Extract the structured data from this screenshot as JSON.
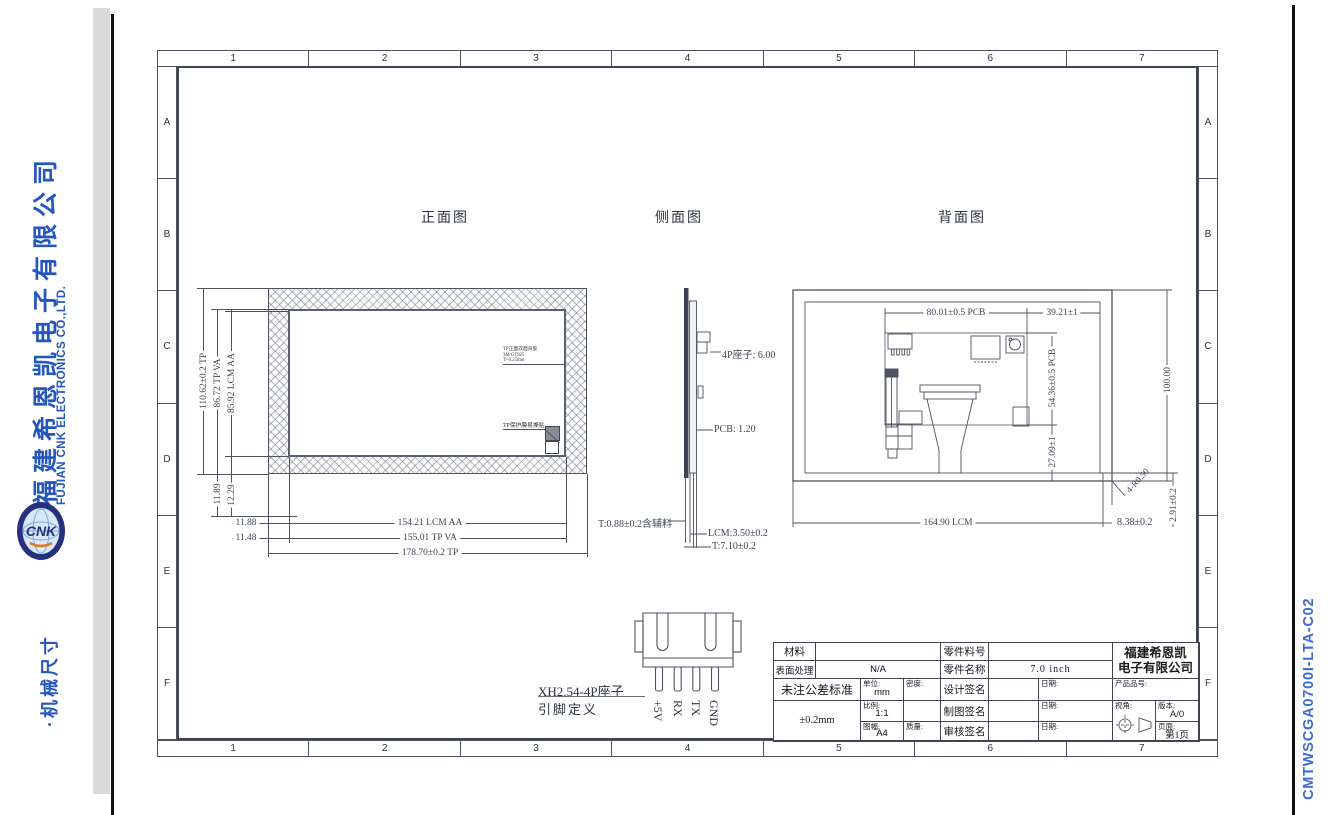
{
  "sidebar": {
    "company_cn": "福建希恩凯电子有限公司",
    "company_en": "FUJIAN CNK ELECTRONICS CO.,LTD.",
    "logo_letters": "CNK",
    "section_title": "·机械尺寸"
  },
  "doc_code": "CMTWSCGA0700I-LTA-C02",
  "frame": {
    "columns": [
      "1",
      "2",
      "3",
      "4",
      "5",
      "6",
      "7"
    ],
    "rows": [
      "A",
      "B",
      "C",
      "D",
      "E",
      "F"
    ]
  },
  "views": {
    "front": {
      "title": "正面图",
      "dim_tp_h": "110.62±0.2 TP",
      "dim_va_h": "86.72 TP VA",
      "dim_aa_h": "85.92 LCM AA",
      "dim_b1": "11.89",
      "dim_b2": "12.29",
      "dim_l1": "11.88",
      "dim_l2": "11.48",
      "dim_aa_w": "154.21 LCM AA",
      "dim_va_w": "155.01 TP VA",
      "dim_tp_w": "178.70±0.2 TP",
      "note_tape_l1": "TP正面双面背胶",
      "note_tape_l2": "3M GT825",
      "note_tape_l3": "T=0.25mm",
      "note_film": "TP保护膜易撕贴"
    },
    "side": {
      "title": "侧面图",
      "dim_conn": "4P座子: 6.00",
      "dim_pcb": "PCB: 1.20",
      "dim_tp": "T:0.88±0.2含辅料",
      "dim_lcm": "LCM:3.50±0.2",
      "dim_total": "T:7.10±0.2"
    },
    "back": {
      "title": "背面图",
      "dim_pcb_w": "80.01±0.5 PCB",
      "dim_right_w": "39.21±1",
      "dim_pcb_h": "54.36±0.5 PCB",
      "dim_conn_y": "27.09±1",
      "dim_h": "100.00",
      "dim_lcm_w": "164.90 LCM",
      "dim_edge": "8.38±0.2",
      "dim_edge_v": "2.91±0.2",
      "dim_radius": "4-R0.50"
    }
  },
  "connector": {
    "title_line1": "XH2.54-4P座子",
    "title_line2": "引脚定义",
    "pins": [
      "+5V",
      "RX",
      "TX",
      "GND"
    ]
  },
  "title_block": {
    "material_label": "材料",
    "material_value": "",
    "surface_label": "表面处理",
    "surface_value": "N/A",
    "tolerance_label": "未注公差标准",
    "tolerance_value": "±0.2mm",
    "unit_label": "单位:",
    "unit_value": "mm",
    "density_label": "密度:",
    "scale_label": "比例:",
    "scale_value": "1:1",
    "format_label": "图幅:",
    "format_value": "A4",
    "mass_label": "质量:",
    "part_no_label": "零件料号",
    "part_no_value": "",
    "part_name_label": "零件名称",
    "part_name_value": "7.0 inch",
    "design_label": "设计签名",
    "draft_label": "制图签名",
    "audit_label": "审核签名",
    "date_label": "日期:",
    "company_line1": "福建希恩凯",
    "company_line2": "电子有限公司",
    "product_no_label": "产品品号:",
    "view_label": "视角:",
    "version_label": "版本:",
    "version_value": "A/0",
    "page_label": "页面:",
    "page_value": "第1页"
  },
  "colors": {
    "accent_blue": "#2456c0",
    "code_blue": "#3c6bd2",
    "line": "#4d525e",
    "logo_navy": "#25317f"
  }
}
